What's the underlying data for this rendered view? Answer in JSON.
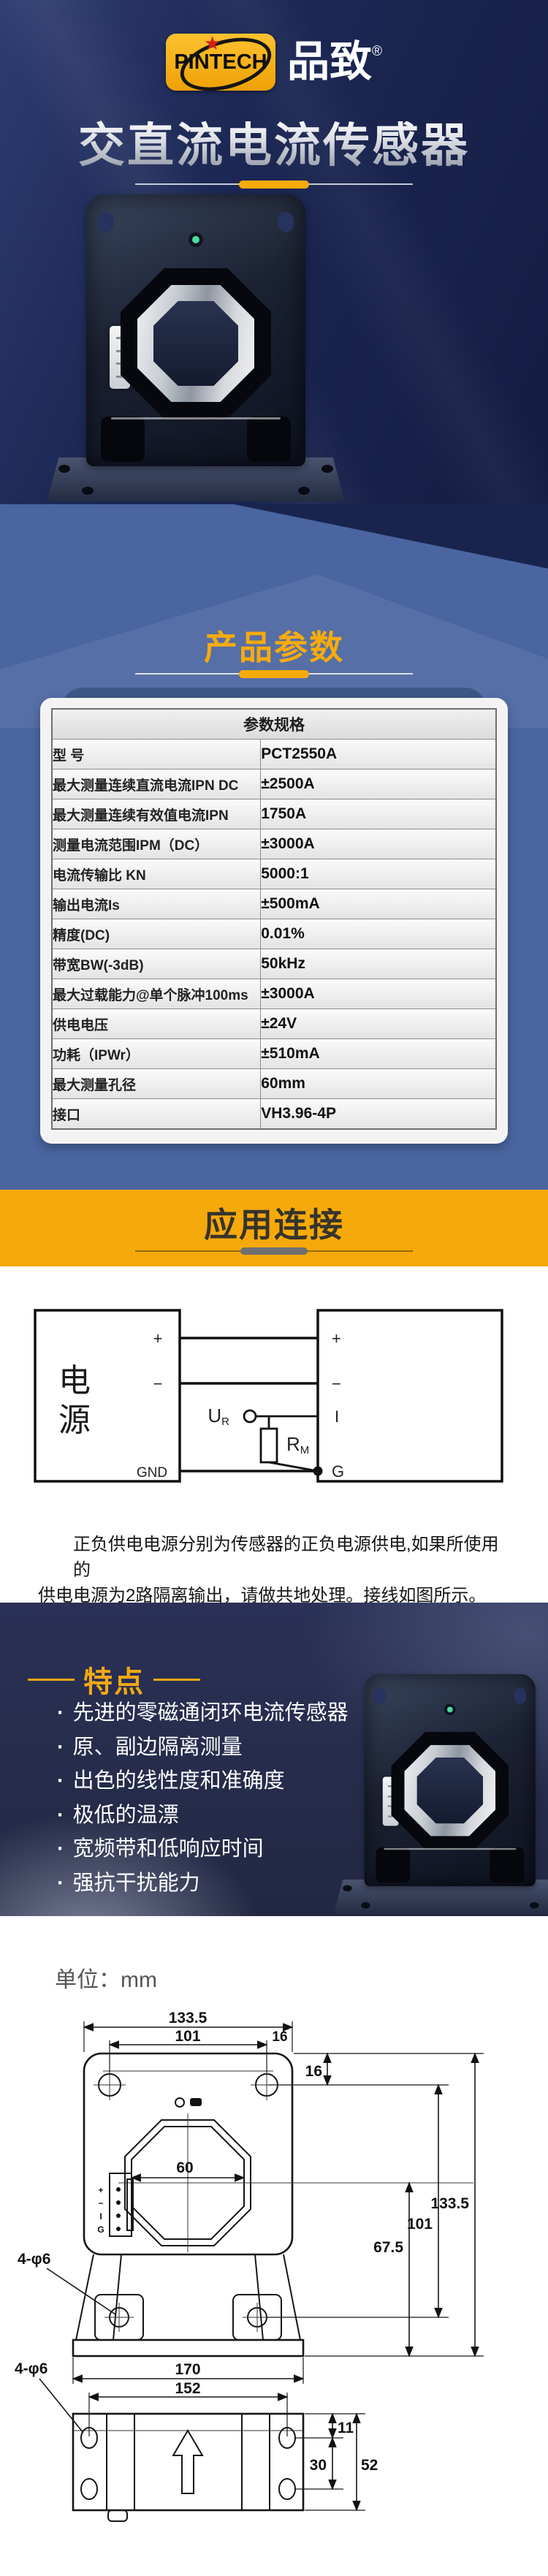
{
  "brand": {
    "logo_text": "PINTECH",
    "logo_cn": "品致",
    "reg": "®"
  },
  "hero": {
    "title": "交直流电流传感器"
  },
  "colors": {
    "accent_yellow": "#f7ab0b",
    "navy": "#1c2a58",
    "slate_blue": "#4a65a0",
    "banner_yellow": "#f6a90a"
  },
  "params": {
    "title": "产品参数",
    "table_header": "参数规格",
    "rows": [
      {
        "label": "型 号",
        "value": "PCT2550A"
      },
      {
        "label": "最大测量连续直流电流IPN DC",
        "value": "±2500A"
      },
      {
        "label": "最大测量连续有效值电流IPN",
        "value": "1750A"
      },
      {
        "label": "测量电流范围IPM（DC）",
        "value": "±3000A"
      },
      {
        "label": "电流传输比 KN",
        "value": "5000:1"
      },
      {
        "label": "输出电流Is",
        "value": "±500mA"
      },
      {
        "label": "精度(DC)",
        "value": "0.01%"
      },
      {
        "label": "带宽BW(-3dB)",
        "value": "50kHz"
      },
      {
        "label": "最大过载能力@单个脉冲100ms",
        "value": "±3000A"
      },
      {
        "label": "供电电压",
        "value": "±24V"
      },
      {
        "label": "功耗（IPWr）",
        "value": "±510mA"
      },
      {
        "label": "最大测量孔径",
        "value": "60mm"
      },
      {
        "label": "接口",
        "value": "VH3.96-4P"
      }
    ]
  },
  "connection": {
    "title": "应用连接",
    "note_line1": "正负供电电源分别为传感器的正负电源供电,如果所使用的",
    "note_line2": "供电电源为2路隔离输出，请做共地处理。接线如图所示。",
    "diagram": {
      "source_label": "电源",
      "source_terminals": [
        "+",
        "−",
        "GND"
      ],
      "sensor_terminals": [
        "+",
        "−",
        "I",
        "G"
      ],
      "ur_main": "U",
      "ur_sub": "R",
      "rm_main": "R",
      "rm_sub": "M"
    }
  },
  "features": {
    "title": "特点",
    "items": [
      "先进的零磁通闭环电流传感器",
      "原、副边隔离测量",
      "出色的线性度和准确度",
      "极低的温漂",
      "宽频带和低响应时间",
      "强抗干扰能力"
    ]
  },
  "dimensions": {
    "unit_label": "单位：mm",
    "front_view": {
      "total_width": "133.5",
      "hole_spacing_h": "101",
      "offset_right": "16",
      "offset_top": "16",
      "total_height": "133.5",
      "hole_spacing_v": "101",
      "center_to_base": "67.5",
      "aperture": "60",
      "holes_label": "4-φ6",
      "pins": [
        "+",
        "−",
        "I",
        "G"
      ]
    },
    "bottom_view": {
      "total_width": "170",
      "hole_spacing": "152",
      "edge_offset": "11",
      "hole_pitch": "30",
      "depth": "52",
      "holes_label": "4-φ6"
    }
  }
}
